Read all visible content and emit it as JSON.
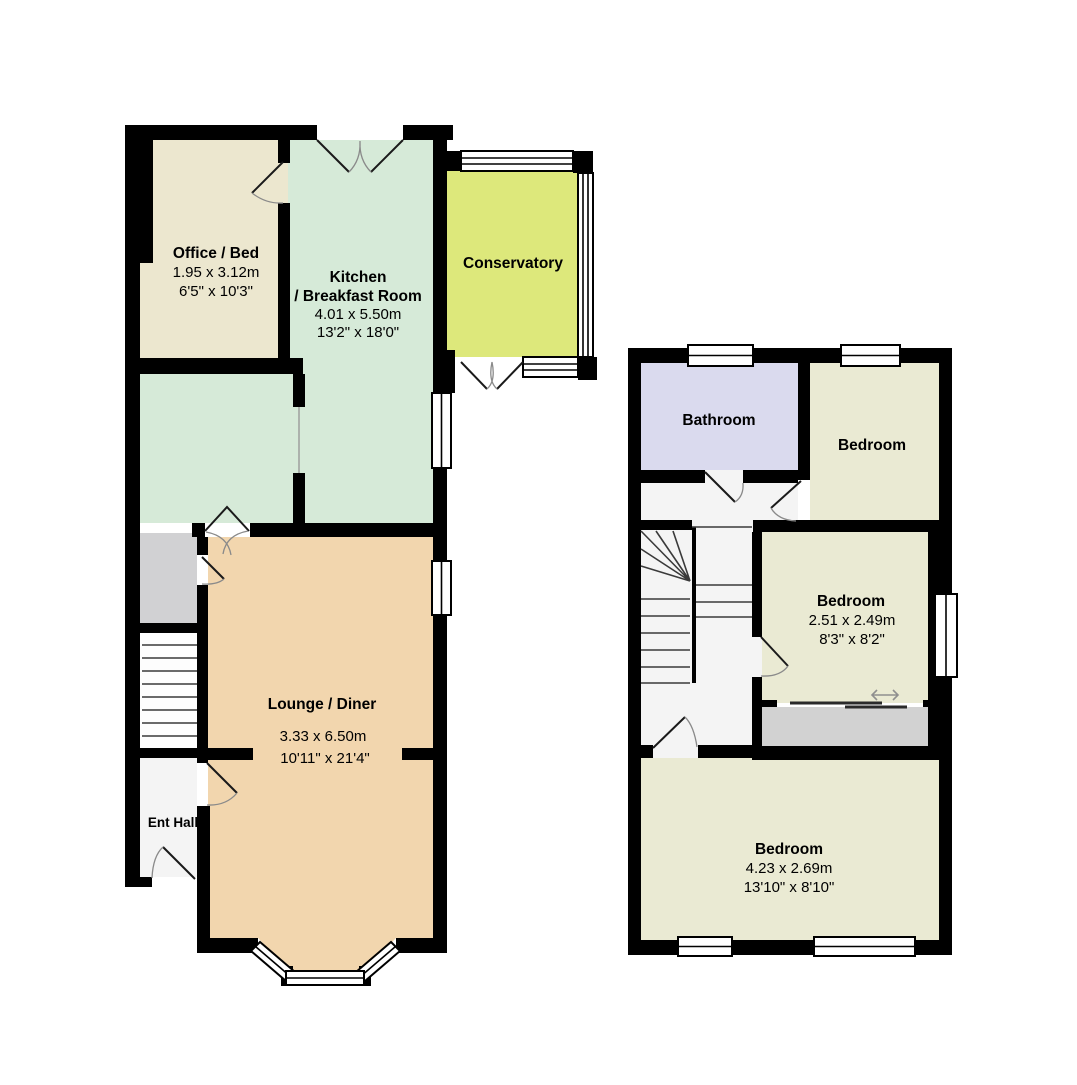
{
  "floorplan": {
    "colors": {
      "wall": "#000000",
      "office": "#ece7cf",
      "kitchen": "#d6ead8",
      "conservatory": "#dde87b",
      "lounge": "#f2d6ae",
      "porch": "#d1d1d3",
      "hall": "#f4f4f4",
      "bathroom": "#dadaee",
      "bedroom": "#eaead3",
      "landing": "#f4f4f4",
      "storage": "#d2d2d2"
    },
    "ground_floor": {
      "rooms": {
        "office": {
          "name": "Office / Bed",
          "dim_m": "1.95 x 3.12m",
          "dim_ft": "6'5\" x 10'3\""
        },
        "kitchen": {
          "name_line1": "Kitchen",
          "name_line2": "/ Breakfast Room",
          "dim_m": "4.01 x 5.50m",
          "dim_ft": "13'2\" x 18'0\""
        },
        "conservatory": {
          "name": "Conservatory"
        },
        "lounge": {
          "name": "Lounge / Diner",
          "dim_m": "3.33 x 6.50m",
          "dim_ft": "10'11\" x 21'4\""
        },
        "ent_hall": {
          "name": "Ent Hall"
        }
      }
    },
    "first_floor": {
      "rooms": {
        "bathroom": {
          "name": "Bathroom"
        },
        "bedroom_front": {
          "name": "Bedroom"
        },
        "bedroom_middle": {
          "name": "Bedroom",
          "dim_m": "2.51 x 2.49m",
          "dim_ft": "8'3\" x 8'2\""
        },
        "bedroom_back": {
          "name": "Bedroom",
          "dim_m": "4.23 x 2.69m",
          "dim_ft": "13'10\" x 8'10\""
        }
      }
    }
  }
}
